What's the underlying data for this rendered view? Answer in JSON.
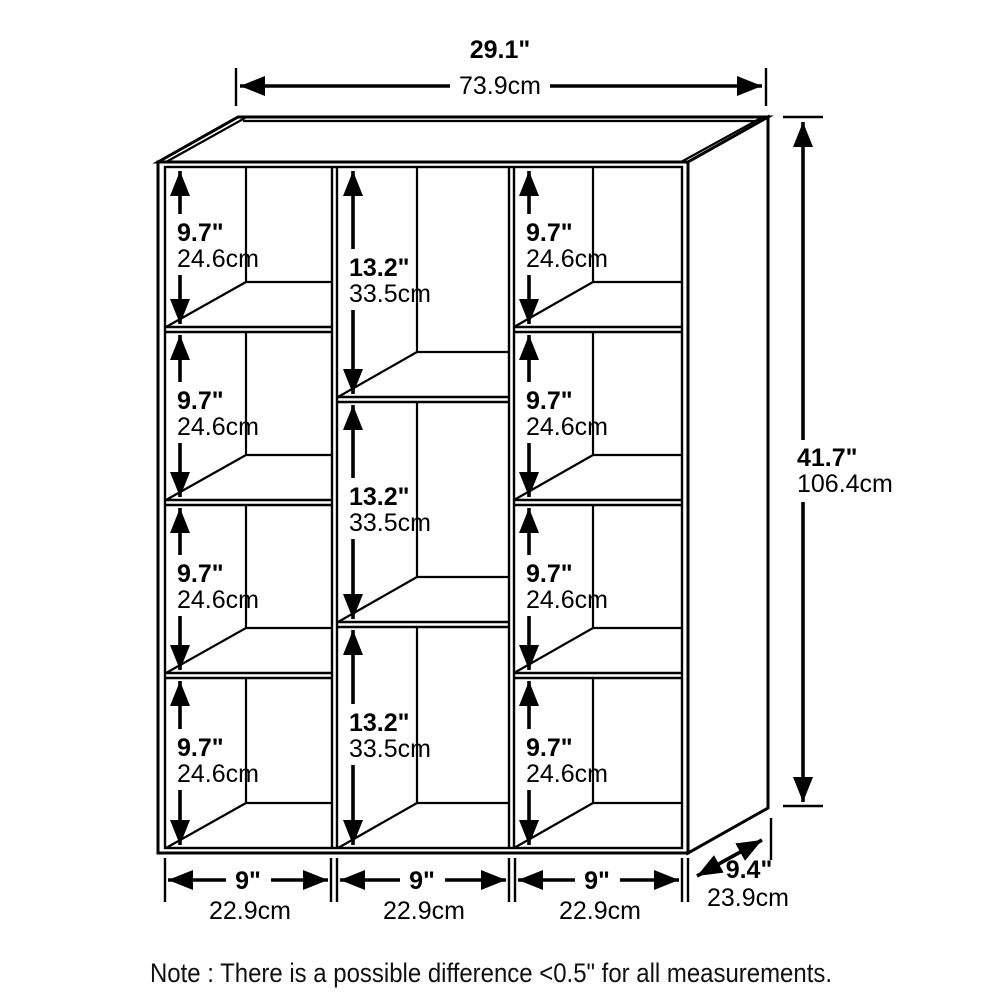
{
  "note": "Note : There is a possible difference <0.5\" for all measurements.",
  "colors": {
    "line": "#000000",
    "background": "#ffffff"
  },
  "overall": {
    "width_in": "29.1\"",
    "width_cm": "73.9cm",
    "height_in": "41.7\"",
    "height_cm": "106.4cm",
    "depth_in": "9.4\"",
    "depth_cm": "23.9cm"
  },
  "columns": {
    "widths": [
      {
        "in": "9\"",
        "cm": "22.9cm"
      },
      {
        "in": "9\"",
        "cm": "22.9cm"
      },
      {
        "in": "9\"",
        "cm": "22.9cm"
      }
    ]
  },
  "cubes": {
    "left": [
      {
        "in": "9.7\"",
        "cm": "24.6cm"
      },
      {
        "in": "9.7\"",
        "cm": "24.6cm"
      },
      {
        "in": "9.7\"",
        "cm": "24.6cm"
      },
      {
        "in": "9.7\"",
        "cm": "24.6cm"
      }
    ],
    "middle": [
      {
        "in": "13.2\"",
        "cm": "33.5cm"
      },
      {
        "in": "13.2\"",
        "cm": "33.5cm"
      },
      {
        "in": "13.2\"",
        "cm": "33.5cm"
      }
    ],
    "right": [
      {
        "in": "9.7\"",
        "cm": "24.6cm"
      },
      {
        "in": "9.7\"",
        "cm": "24.6cm"
      },
      {
        "in": "9.7\"",
        "cm": "24.6cm"
      },
      {
        "in": "9.7\"",
        "cm": "24.6cm"
      }
    ]
  }
}
